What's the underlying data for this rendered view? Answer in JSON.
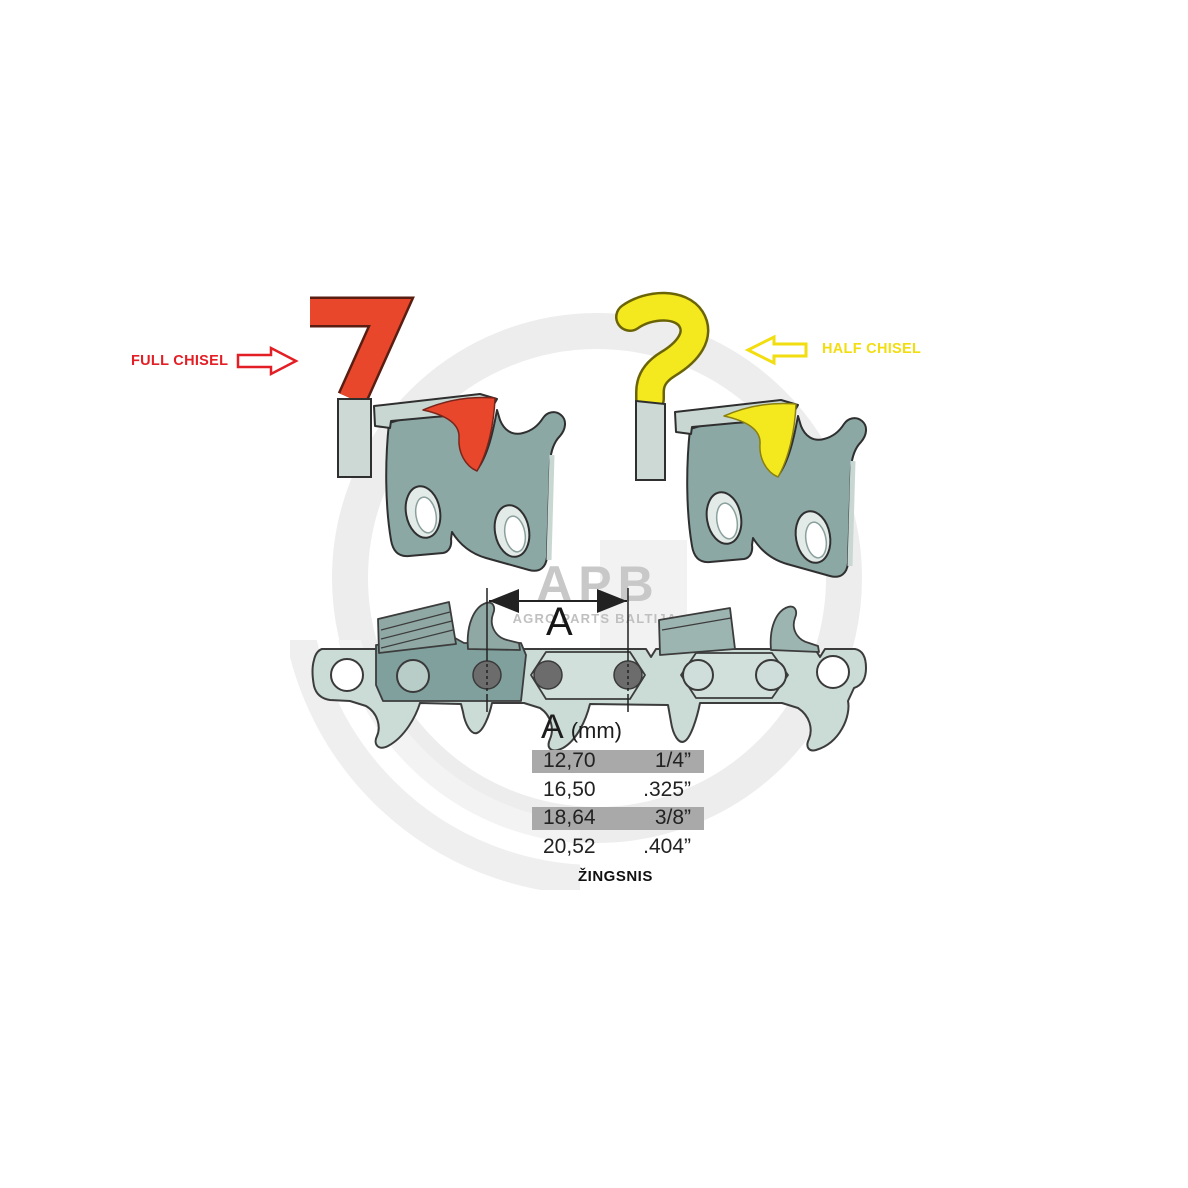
{
  "diagram": {
    "annotations": {
      "full_chisel": "FULL CHISEL",
      "half_chisel": "HALF CHISEL",
      "dimension_letter": "A"
    },
    "watermark": {
      "abbr": "APB",
      "name": "AGRO PARTS BALTIJA"
    },
    "pitch_table": {
      "header": {
        "letter": "A",
        "unit": "(mm)"
      },
      "rows": [
        {
          "mm": "12,70",
          "inch": "1/4”",
          "highlighted": true
        },
        {
          "mm": "16,50",
          "inch": ".325”",
          "highlighted": false
        },
        {
          "mm": "18,64",
          "inch": "3/8”",
          "highlighted": true
        },
        {
          "mm": "20,52",
          "inch": ".404”",
          "highlighted": false
        }
      ],
      "caption": "ŽINGSNIS"
    },
    "colors": {
      "full_chisel": "#e8472c",
      "full_chisel_text": "#e31e24",
      "half_chisel": "#f4e81f",
      "half_chisel_text": "#f2de10",
      "link_body": "#8ba8a5",
      "link_light": "#c9d7d3",
      "chain_band": "#cbdbd6",
      "cutter_dark": "#7fa09d",
      "rivet": "#6c6c6c",
      "row_highlight": "#a9a9a9",
      "watermark_gray": "#c8c8c8"
    }
  }
}
